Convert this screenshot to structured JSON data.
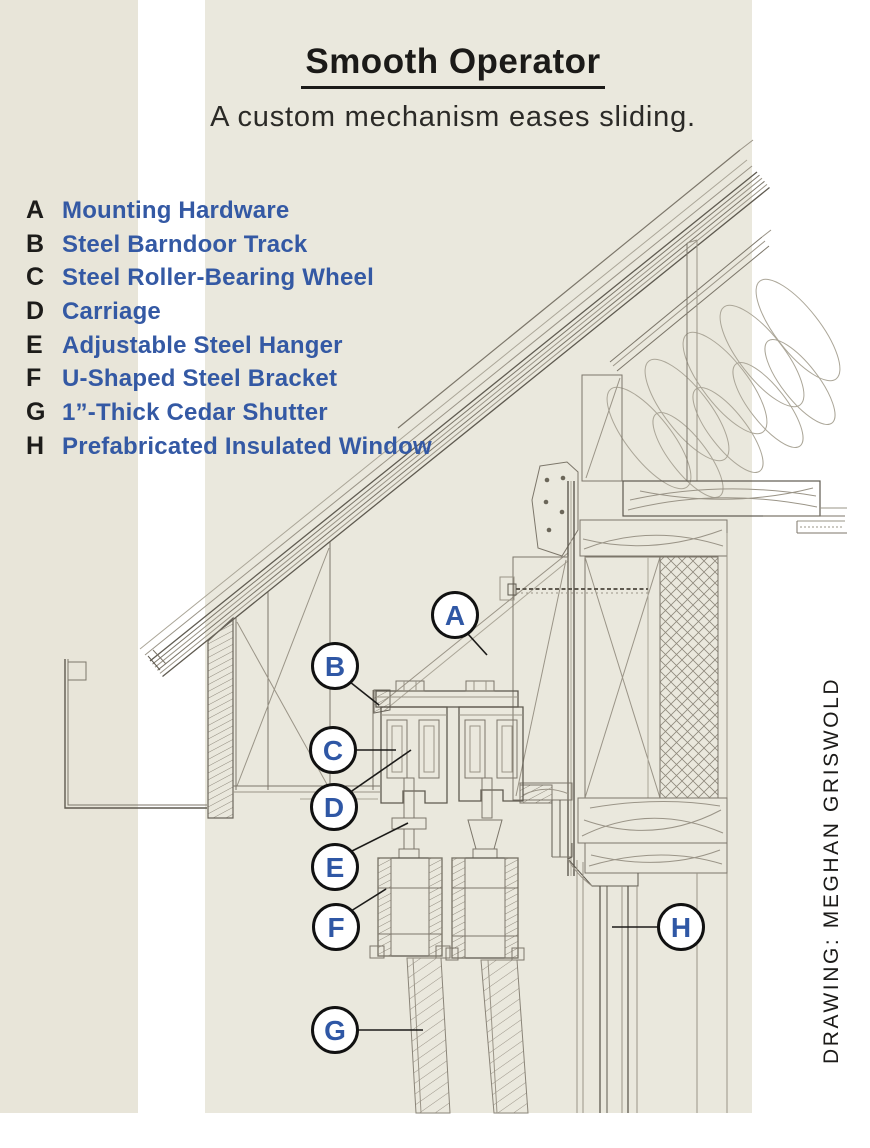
{
  "page": {
    "title": "Smooth Operator",
    "subtitle": "A custom mechanism eases sliding.",
    "credit": "DRAWING: MEGHAN GRISWOLD"
  },
  "legend": {
    "items": [
      {
        "key": "A",
        "label": "Mounting Hardware"
      },
      {
        "key": "B",
        "label": "Steel Barndoor Track"
      },
      {
        "key": "C",
        "label": "Steel Roller-Bearing Wheel"
      },
      {
        "key": "D",
        "label": "Carriage"
      },
      {
        "key": "E",
        "label": "Adjustable Steel Hanger"
      },
      {
        "key": "F",
        "label": "U-Shaped Steel Bracket"
      },
      {
        "key": "G",
        "label": "1”-Thick Cedar Shutter"
      },
      {
        "key": "H",
        "label": "Prefabricated Insulated Window"
      }
    ]
  },
  "callouts": [
    {
      "letter": "A"
    },
    {
      "letter": "B"
    },
    {
      "letter": "C"
    },
    {
      "letter": "D"
    },
    {
      "letter": "E"
    },
    {
      "letter": "F"
    },
    {
      "letter": "G"
    },
    {
      "letter": "H"
    }
  ],
  "colors": {
    "accent_blue": "#3459a4",
    "ink_black": "#1b1a18",
    "panel_beige_main": "#eae8dd",
    "panel_beige_left": "#e8e5d9",
    "sketch_line": "#7c766a",
    "background": "#ffffff"
  }
}
